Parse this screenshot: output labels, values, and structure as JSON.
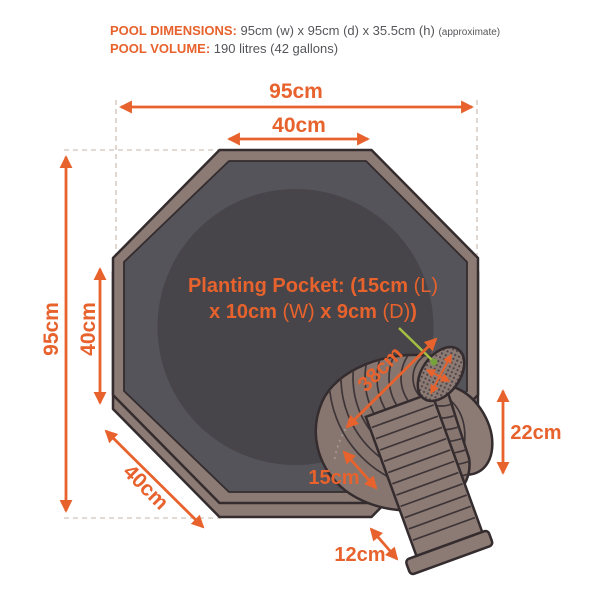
{
  "header": {
    "dimensions_label": "POOL DIMENSIONS:",
    "dimensions_value": " 95cm (w) x 95cm (d) x 35.5cm (h) ",
    "dimensions_note": "(approximate)",
    "volume_label": "POOL VOLUME:",
    "volume_value": " 190 litres (42 gallons)"
  },
  "dimensions": {
    "pool_width_top": "95cm",
    "top_edge": "40cm",
    "pool_height_left": "95cm",
    "left_edge": "40cm",
    "bottom_left_edge": "40cm",
    "pocket_distance": "38cm",
    "cascade_inner": "15cm",
    "cascade_height": "22cm",
    "spillway_lip": "12cm"
  },
  "pocket_label": {
    "line1": [
      {
        "text": "Planting Pocket: (15cm ",
        "bold": true
      },
      {
        "text": "(L)",
        "bold": false
      }
    ],
    "line2": [
      {
        "text": "x 10cm ",
        "bold": true
      },
      {
        "text": "(W)",
        "bold": false
      },
      {
        "text": " x 9cm ",
        "bold": true
      },
      {
        "text": "(D)",
        "bold": false
      },
      {
        "text": ")",
        "bold": true
      }
    ]
  },
  "colors": {
    "accent_orange": "#E7622C",
    "pointer_green": "#A4C043",
    "pool_rim": "#8C7B74",
    "pool_inner": "#55545A",
    "pool_floor": "#474549",
    "outline": "#342C2E",
    "text_gray": "#55565A",
    "dash_line": "#D8CDC5"
  }
}
